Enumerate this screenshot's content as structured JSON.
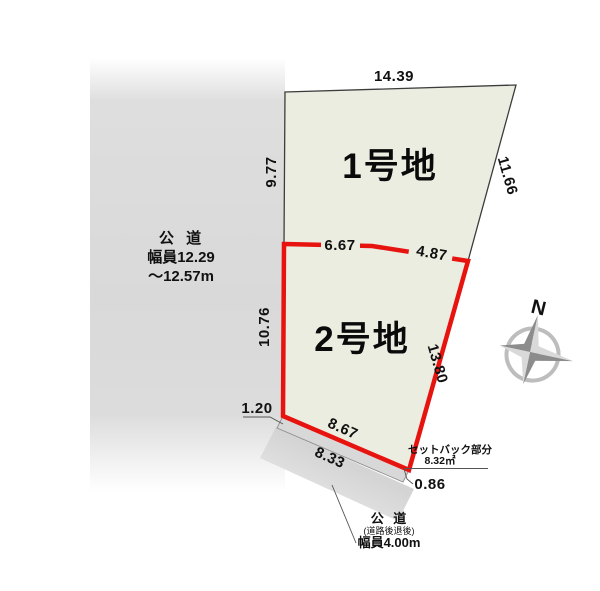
{
  "colors": {
    "parcel_fill": "#ecede1",
    "parcel_stroke": "#3c3c3c",
    "boundary_red": "#e7130f",
    "road_gray": "#dcdcdc",
    "setback_gray": "#d8d8d8",
    "leader_gray": "#555555"
  },
  "left_road": {
    "name_line": "公 道",
    "width_line1": "幅員12.29",
    "width_line2": "～12.57m"
  },
  "lot1": {
    "label": "1号地",
    "dim_top": "14.39",
    "dim_left": "9.77",
    "dim_right": "11.66"
  },
  "lot2": {
    "label": "2号地",
    "dim_top_left": "6.67",
    "dim_top_right": "4.87",
    "dim_left": "10.76",
    "dim_right": "13.80",
    "dim_bottom": "8.67",
    "dim_corner": "1.20"
  },
  "setback": {
    "title": "セットバック部分",
    "area": "8.32㎡",
    "dim_bottom": "8.33",
    "dim_right": "0.86"
  },
  "bottom_road": {
    "name_line": "公 道",
    "note_line": "(道路後退後)",
    "width_line": "幅員4.00m"
  },
  "compass": {
    "north": "N"
  }
}
